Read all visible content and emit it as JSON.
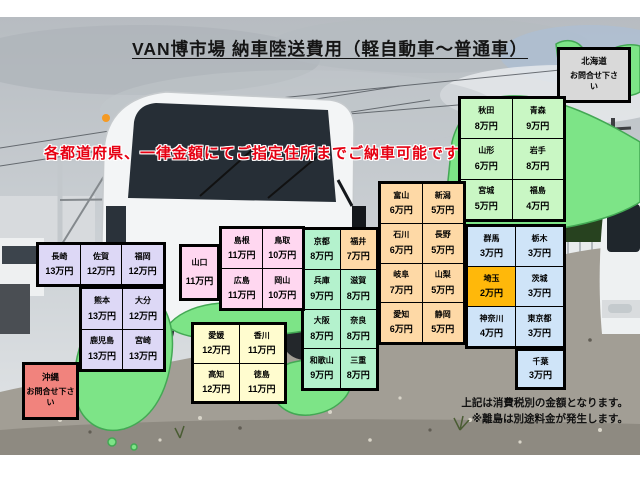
{
  "title": "VAN博市場 納車陸送費用（軽自動車～普通車）",
  "slogan": "各都道府県、一律金額にてご指定住所までご納車可能です！",
  "notes": {
    "line1": "上記は消費税別の金額となります。",
    "line2": "※離島は別途料金が発生します。"
  },
  "hokkaido": {
    "name": "北海道",
    "note": "お問合せ下さい",
    "bg": "#d9d9d9"
  },
  "okinawa": {
    "name": "沖縄",
    "note": "お問合せ下さい",
    "bg": "#f1837d"
  },
  "map_color": "#7de487",
  "grids": [
    {
      "id": "tohoku",
      "cols": 2,
      "bg": "#c9f7c4",
      "cells": [
        {
          "name": "秋田",
          "price": "8万円"
        },
        {
          "name": "青森",
          "price": "9万円"
        },
        {
          "name": "山形",
          "price": "6万円"
        },
        {
          "name": "岩手",
          "price": "8万円"
        },
        {
          "name": "宮城",
          "price": "5万円"
        },
        {
          "name": "福島",
          "price": "4万円"
        }
      ]
    },
    {
      "id": "chubu",
      "cols": 2,
      "bg": "#fed9a6",
      "cells": [
        {
          "name": "富山",
          "price": "6万円"
        },
        {
          "name": "新潟",
          "price": "5万円"
        },
        {
          "name": "石川",
          "price": "6万円"
        },
        {
          "name": "長野",
          "price": "5万円"
        },
        {
          "name": "岐阜",
          "price": "7万円"
        },
        {
          "name": "山梨",
          "price": "5万円"
        },
        {
          "name": "愛知",
          "price": "6万円"
        },
        {
          "name": "静岡",
          "price": "5万円"
        }
      ]
    },
    {
      "id": "kanto",
      "cols": 2,
      "bg": "#cfe4f8",
      "cells": [
        {
          "name": "群馬",
          "price": "3万円"
        },
        {
          "name": "栃木",
          "price": "3万円"
        },
        {
          "name": "埼玉",
          "price": "2万円",
          "bg": "#ffb80a"
        },
        {
          "name": "茨城",
          "price": "3万円"
        },
        {
          "name": "神奈川",
          "price": "4万円"
        },
        {
          "name": "東京都",
          "price": "3万円"
        }
      ]
    },
    {
      "id": "chiba",
      "cols": 1,
      "bg": "#cfe4f8",
      "cells": [
        {
          "name": "千葉",
          "price": "3万円"
        }
      ]
    },
    {
      "id": "kansai",
      "cols": 2,
      "bg": "#b4f2cd",
      "cells": [
        {
          "name": "京都",
          "price": "8万円"
        },
        {
          "name": "福井",
          "price": "7万円",
          "bg": "#fed9a6"
        },
        {
          "name": "兵庫",
          "price": "9万円"
        },
        {
          "name": "滋賀",
          "price": "8万円"
        },
        {
          "name": "大阪",
          "price": "8万円"
        },
        {
          "name": "奈良",
          "price": "8万円"
        },
        {
          "name": "和歌山",
          "price": "9万円"
        },
        {
          "name": "三重",
          "price": "8万円"
        }
      ]
    },
    {
      "id": "yamaguchi",
      "cols": 1,
      "bg": "#ffd7f0",
      "cells": [
        {
          "name": "山口",
          "price": "11万円"
        }
      ]
    },
    {
      "id": "chugoku",
      "cols": 2,
      "bg": "#ffd7f0",
      "cells": [
        {
          "name": "島根",
          "price": "11万円"
        },
        {
          "name": "鳥取",
          "price": "10万円"
        },
        {
          "name": "広島",
          "price": "11万円"
        },
        {
          "name": "岡山",
          "price": "10万円"
        }
      ]
    },
    {
      "id": "shikoku",
      "cols": 2,
      "bg": "#fffccf",
      "cells": [
        {
          "name": "愛媛",
          "price": "12万円"
        },
        {
          "name": "香川",
          "price": "11万円"
        },
        {
          "name": "高知",
          "price": "12万円"
        },
        {
          "name": "徳島",
          "price": "11万円"
        }
      ]
    },
    {
      "id": "kyushu-north",
      "cols": 3,
      "bg": "#ddd8f6",
      "cells": [
        {
          "name": "長崎",
          "price": "13万円"
        },
        {
          "name": "佐賀",
          "price": "12万円"
        },
        {
          "name": "福岡",
          "price": "12万円"
        }
      ]
    },
    {
      "id": "kyushu-south",
      "cols": 2,
      "bg": "#ddd8f6",
      "cells": [
        {
          "name": "熊本",
          "price": "13万円"
        },
        {
          "name": "大分",
          "price": "12万円"
        },
        {
          "name": "鹿児島",
          "price": "13万円"
        },
        {
          "name": "宮崎",
          "price": "13万円"
        }
      ]
    }
  ]
}
